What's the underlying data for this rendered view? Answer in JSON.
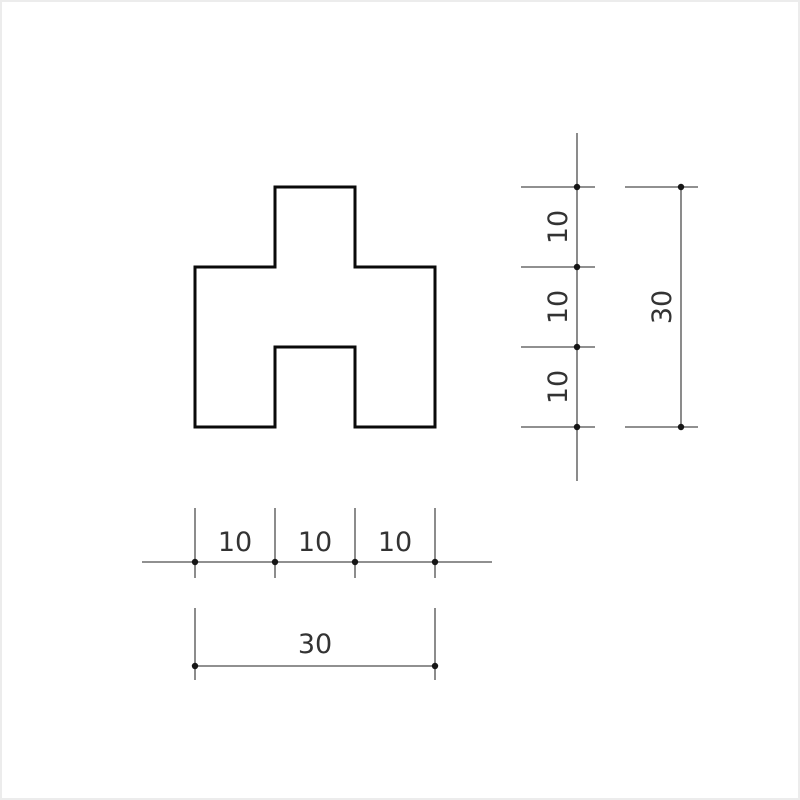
{
  "drawing": {
    "kind": "technical-dimension-drawing",
    "part": {
      "description": "stepped polygon with center tab on top and center notch at bottom"
    },
    "vertical_chain": {
      "labels": [
        "10",
        "10",
        "10"
      ]
    },
    "vertical_total": {
      "label": "30"
    },
    "horizontal_chain": {
      "labels": [
        "10",
        "10",
        "10"
      ]
    },
    "horizontal_total": {
      "label": "30"
    }
  },
  "colors": {
    "background": "#ffffff",
    "part_outline": "#0a0a0a",
    "dimension_line": "#4d4d4d",
    "dimension_dot": "#161616",
    "text": "#333333",
    "page_border": "#ececec"
  }
}
